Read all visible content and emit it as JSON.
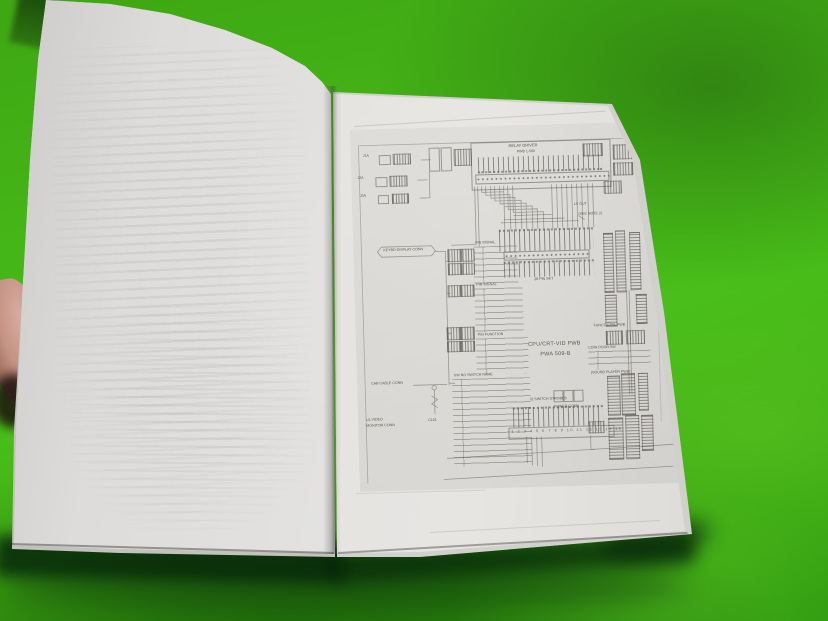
{
  "scene": {
    "description": "Open paperback service manual photographed on a bright green surface; left page nearly blank with faint show-through text, right page shows a photocopied wiring schematic; a thumb holds the left edge"
  },
  "colors": {
    "green_bright": "#48bd19",
    "green_mid": "#3ea714",
    "green_dark": "#2f9b0f",
    "page_light": "#e7e5e2",
    "page_shade": "#c6c5c2",
    "ink": "#5a574f",
    "skin": "#c79b8c"
  },
  "schematic": {
    "title_line1": "CPU/CRT-VID PWB",
    "title_line2": "PWA 509-B",
    "top_box_title1": "RELAY DRIVER",
    "top_box_title2": "PWB 1-500",
    "conn1_label": "J1A",
    "conn2_label": "J2A",
    "conn3_label": "J3A",
    "hex_label": "KEYBD DISPLAY CONN",
    "note_line1": "L5 OUT",
    "note_line2": "(SEE NOTE 2)",
    "socket_label": "28 PIN SKT",
    "table1_header": "PIN SIGNAL",
    "table2_header": "PIN SIGNAL",
    "table3_header": "PIN FUNCTION",
    "table4_header": "SW NO SWITCH NAME",
    "func_label": "FUNCT CTRL PWB",
    "coin_label": "COIN DOOR SW",
    "legend_label": "(SOUND PLAYER PWB)",
    "power_label": "POWER CONN",
    "strobes_label": "J2 SWITCH STROBES",
    "strip_numbers": "1 2 3 4 5 6 7 8 9 10 11 12 13 14 15",
    "cab_label": "CAB CABLE CONN",
    "video_label1": "UL VIDEO",
    "video_label2": "MONITOR CONN",
    "comp_label": "C101"
  }
}
